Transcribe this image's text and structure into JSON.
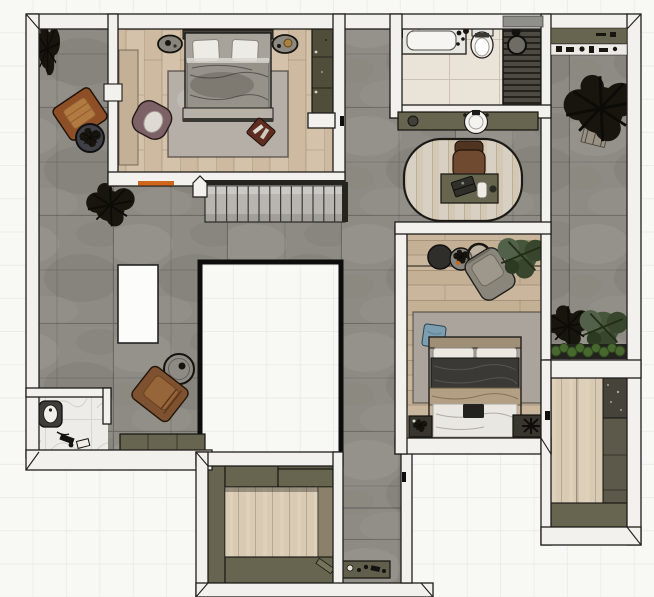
{
  "meta": {
    "title": "2D furnished floor plan – top-down sketch render",
    "canvas_width": 654,
    "canvas_height": 597,
    "view": "plan view on white grid canvas"
  },
  "palette": {
    "background": "#f8f8f5",
    "grid_line": "#e9e8e3",
    "wall_fill": "#f2f1ee",
    "wall_outline": "#1f1e1b",
    "concrete_floor": "#8e8b85",
    "wood_light": "#d4c2aa",
    "wood_mid": "#c9b69d",
    "wood_pale": "#d9cab3",
    "tile_beige": "#eae4d8",
    "marble_white": "#edece8",
    "cabinet_olive": "#67644f",
    "shower_slats": "#4c4a42",
    "rug_gray": "#b5afa7",
    "accent_orange": "#d0661c",
    "patio_leather_orange": "#8f4f26",
    "lounge_leather_brown": "#7e5230",
    "armchair_mauve": "#7c6166",
    "pillow_blue": "#7b9fb0",
    "duvet_dark": "#3a3935",
    "blanket_tan": "#b3a084",
    "plant_dark": "#17150e",
    "plant_green": "#46563a",
    "planter_shrub_green": "#49682f",
    "stair_tread": "#b8b5b0"
  },
  "rooms": {
    "living": {
      "label": "Living area with concrete tile floor"
    },
    "terrace_left": {
      "label": "Left patio strip"
    },
    "master_bedroom": {
      "label": "Master bedroom"
    },
    "lightwell": {
      "label": "Light-well passage"
    },
    "bathroom": {
      "label": "Bathroom"
    },
    "study": {
      "label": "Study nook"
    },
    "bedroom2": {
      "label": "Second bedroom"
    },
    "terrace_right": {
      "label": "Right terrace with plants"
    },
    "closet_right": {
      "label": "Right wardrobe room"
    },
    "closet_bottom": {
      "label": "Walk-in closet"
    },
    "entry": {
      "label": "Entry corridor"
    },
    "powder": {
      "label": "Powder room with toilet"
    },
    "stairs": {
      "label": "Staircase"
    },
    "void": {
      "label": "Floor opening / stair void"
    }
  },
  "furniture": {
    "bed1": {
      "label": "Double bed, white pillows, grey duvet"
    },
    "rug1": {
      "label": "Grey bedroom rug"
    },
    "wardrobe1": {
      "label": "Dark wardrobe"
    },
    "dresser1": {
      "label": "Low dresser"
    },
    "armchair_mauve": {
      "label": "Mauve accent armchair"
    },
    "nightstand_left": {
      "label": "Round nightstand"
    },
    "nightstand_right": {
      "label": "Round nightstand with brass decor"
    },
    "patio_chair": {
      "label": "Orange leather patio chair"
    },
    "patio_table": {
      "label": "Dark round side table with plant"
    },
    "island": {
      "label": "White island table"
    },
    "lounge_brown": {
      "label": "Brown lounge armchair"
    },
    "side_table_living": {
      "label": "Round side table"
    },
    "bench": {
      "label": "Low olive bench"
    },
    "toilet_powder": {
      "label": "Toilet"
    },
    "bathtub": {
      "label": "Bathtub"
    },
    "toilet_bath": {
      "label": "Toilet"
    },
    "shower": {
      "label": "Walk-in shower with slatted floor"
    },
    "vanity": {
      "label": "Vanity counter with round basin"
    },
    "desk": {
      "label": "Desk with laptop and cup"
    },
    "desk_chair": {
      "label": "Brown desk chair"
    },
    "office_rug": {
      "label": "Oval plank-weave rug"
    },
    "bed2": {
      "label": "Double bed, dark duvet, tan throw, blue cushion"
    },
    "lounge_gray": {
      "label": "Grey lounge chair"
    },
    "side_table_trio": {
      "label": "Nesting round side tables"
    },
    "night2_left": {
      "label": "Nightstand with plant"
    },
    "night2_right": {
      "label": "Nightstand with black lamp"
    },
    "console": {
      "label": "Entry console with shoes"
    },
    "closet_cabinets": {
      "label": "Walk-in closet cabinetry"
    },
    "right_cabinets": {
      "label": "Wardrobe cabinetry"
    },
    "planter": {
      "label": "Planter box with shrubs"
    },
    "big_plant": {
      "label": "Large potted plant"
    },
    "tree_living": {
      "label": "Dry branch plant"
    },
    "utility_shelf": {
      "label": "Utility shelf with small items"
    }
  }
}
